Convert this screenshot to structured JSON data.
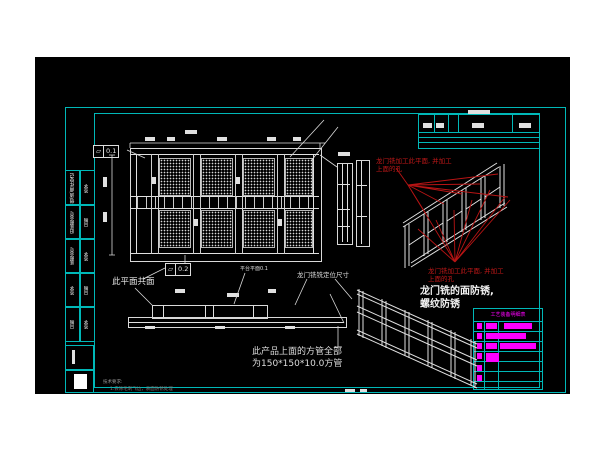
{
  "colors": {
    "canvas_bg": "#000000",
    "frame_cyan": "#00b8b8",
    "line_white": "#e0e0e0",
    "annotation_red": "#c01818",
    "highlight_magenta": "#ff00ff"
  },
  "notes": {
    "red_top_1": "龙门铣加工此平面, 并加工",
    "red_top_2": "上面的孔",
    "red_mid_1": "龙门铣加工此平面, 并加工",
    "red_mid_2": "上面的孔",
    "rust_1": "龙门铣的面防锈,",
    "rust_2": "螺纹防锈",
    "product_1": "此产品上面的方管全部",
    "product_2": "为150*150*10.0方管",
    "coplanar": "此平面共面",
    "platform": "平台平面0.1",
    "gantry": "龙门铣铣定位尺寸",
    "tech_title": "技术要求:",
    "tech_item": "1.去除毛刺飞边，表面防锈处理"
  },
  "tolerances": {
    "top": {
      "symbol": "▱",
      "value": "0.1"
    },
    "bottom": {
      "symbol": "▱",
      "value": "0.2"
    }
  },
  "left_strip": {
    "fields": [
      {
        "label": "借(通)用件登记",
        "sub": "签字"
      },
      {
        "label": "旧底图总号",
        "sub": "日期"
      },
      {
        "label": "底图总号",
        "sub": "签字"
      },
      {
        "label": "签字",
        "sub": "日期"
      },
      {
        "label": "日期",
        "sub": "签字"
      }
    ]
  },
  "parts_table": {
    "header": "工艺装备明细表"
  }
}
